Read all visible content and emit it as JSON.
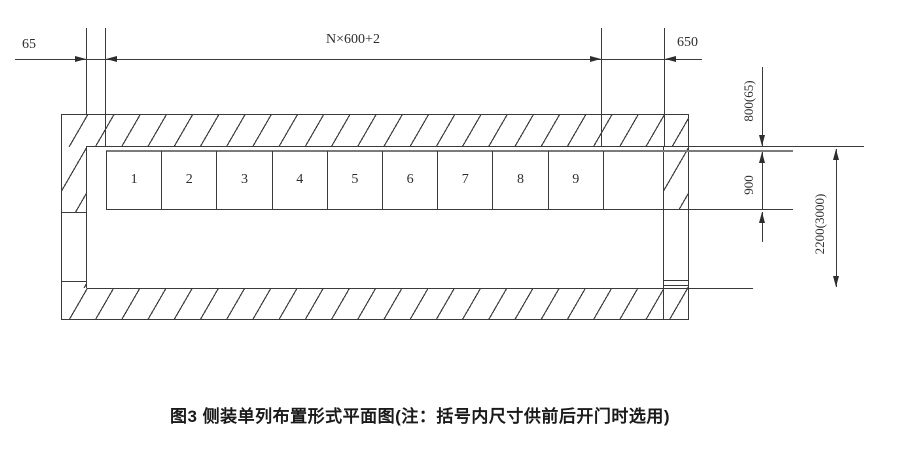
{
  "figure": {
    "caption": "图3 侧装单列布置形式平面图(注：括号内尺寸供前后开门时选用)",
    "dims": {
      "left_wall_offset": "65",
      "row_width": "N×600+2",
      "right_offset": "650",
      "top_clearance": "800(65)",
      "cabinet_depth": "900",
      "room_depth": "2200(3000)"
    },
    "cells": [
      "1",
      "2",
      "3",
      "4",
      "5",
      "6",
      "7",
      "8",
      "9",
      ""
    ]
  }
}
